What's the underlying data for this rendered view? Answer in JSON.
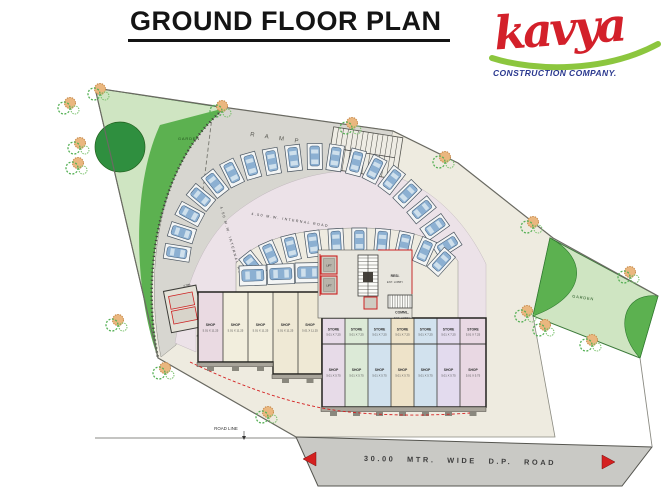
{
  "header": {
    "title": "GROUND FLOOR PLAN"
  },
  "logo": {
    "brand": "kavya",
    "tagline": "CONSTRUCTION COMPANY.",
    "brand_color": "#d3202a",
    "swoosh_color": "#8cc63e",
    "tagline_color": "#2b3990"
  },
  "colors": {
    "plot": "#eeebe0",
    "ramp_band": "#d7d6d0",
    "internal_road": "#ece2e8",
    "court": "#eeebe0",
    "dp_road": "#c9c9c5",
    "garden_light": "#cfe5c2",
    "garden_mid": "#5cb150",
    "garden_dark": "#2f8f3f",
    "accent_red": "#d42020",
    "car_blue": "#8cb0d2"
  },
  "plan": {
    "labels": {
      "garden_left": "GARDEN",
      "garden_right": "GARDEN",
      "ramp": "R A M P",
      "internal_road_top": "4.50 M.W. INTERNAL ROAD",
      "internal_road_left": "4.50 M.W. INTERNAL ROAD",
      "resi_lobby_1": "RESI.",
      "resi_lobby_2": "ENT. LOBBY",
      "comml_lobby_1": "COMML.",
      "comml_lobby_2": "ENT. LOBBY",
      "lift": "LIFT",
      "utility_dim": "4.70M",
      "road_line": "ROAD LINE",
      "dp_road": "30.00 MTR. WIDE D.P. ROAD"
    },
    "left_shops": [
      {
        "name": "SHOP",
        "dim": "5.01 X 11.25",
        "fill": "#eadae2"
      },
      {
        "name": "SHOP",
        "dim": "5.01 X 11.25",
        "fill": "#f2eedd"
      },
      {
        "name": "SHOP",
        "dim": "5.01 X 11.25",
        "fill": "#f2eedd"
      },
      {
        "name": "SHOP",
        "dim": "5.01 X 11.25",
        "fill": "#efe9d5"
      },
      {
        "name": "SHOP",
        "dim": "5.01 X 11.25",
        "fill": "#efe9d5"
      }
    ],
    "stores": [
      {
        "name": "STORE",
        "dim": "5.01 X 7.25",
        "fill": "#e7dbe8"
      },
      {
        "name": "STORE",
        "dim": "5.01 X 7.25",
        "fill": "#dcead7"
      },
      {
        "name": "STORE",
        "dim": "5.01 X 7.25",
        "fill": "#d2e2ee"
      },
      {
        "name": "STORE",
        "dim": "5.01 X 7.25",
        "fill": "#eee3c9"
      },
      {
        "name": "STORE",
        "dim": "5.01 X 7.25",
        "fill": "#d2e2ee"
      },
      {
        "name": "STORE",
        "dim": "5.01 X 7.25",
        "fill": "#e3dbee"
      },
      {
        "name": "STORE",
        "dim": "5.01 X 7.25",
        "fill": "#e9d8e3"
      }
    ],
    "right_shops": [
      {
        "name": "SHOP",
        "dim": "5.01 X 5.75",
        "fill": "#e7dbe8"
      },
      {
        "name": "SHOP",
        "dim": "5.01 X 5.75",
        "fill": "#dcead7"
      },
      {
        "name": "SHOP",
        "dim": "5.01 X 5.75",
        "fill": "#d2e2ee"
      },
      {
        "name": "SHOP",
        "dim": "5.01 X 5.75",
        "fill": "#eee3c9"
      },
      {
        "name": "SHOP",
        "dim": "5.01 X 5.75",
        "fill": "#d2e2ee"
      },
      {
        "name": "SHOP",
        "dim": "5.01 X 5.75",
        "fill": "#e3dbee"
      },
      {
        "name": "SHOP",
        "dim": "5.01 X 5.75",
        "fill": "#e9d8e3"
      }
    ]
  }
}
